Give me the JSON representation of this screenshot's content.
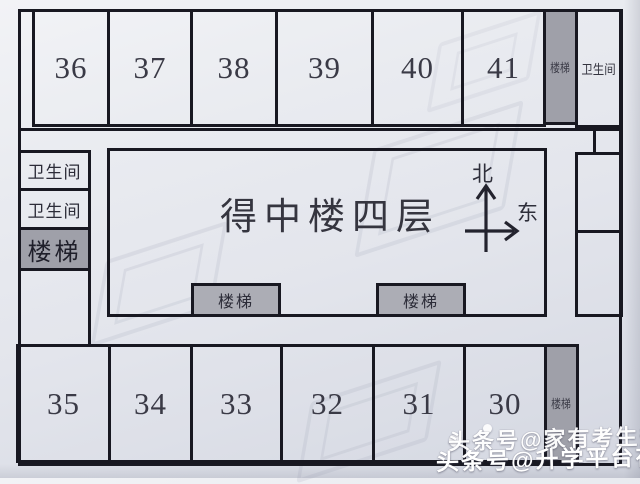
{
  "title": "得中楼四层",
  "labels": {
    "restroom": "卫生间",
    "stairs": "楼梯"
  },
  "compass": {
    "north": "北",
    "east": "东"
  },
  "rooms": {
    "top": [
      "36",
      "37",
      "38",
      "39",
      "40",
      "41"
    ],
    "bottom": [
      "35",
      "34",
      "33",
      "32",
      "31",
      "30"
    ]
  },
  "watermarks": {
    "overlay_line1": "头条号@家有考生升学帮",
    "overlay_line2": "头条号@升学平台在线"
  },
  "colors": {
    "wall_line": "#181821",
    "paper": "#e7e9ef",
    "stairs_fill": "#9fa0a9",
    "stairs_fill_light": "#acadb5",
    "overlay_text": "#ffffff"
  }
}
